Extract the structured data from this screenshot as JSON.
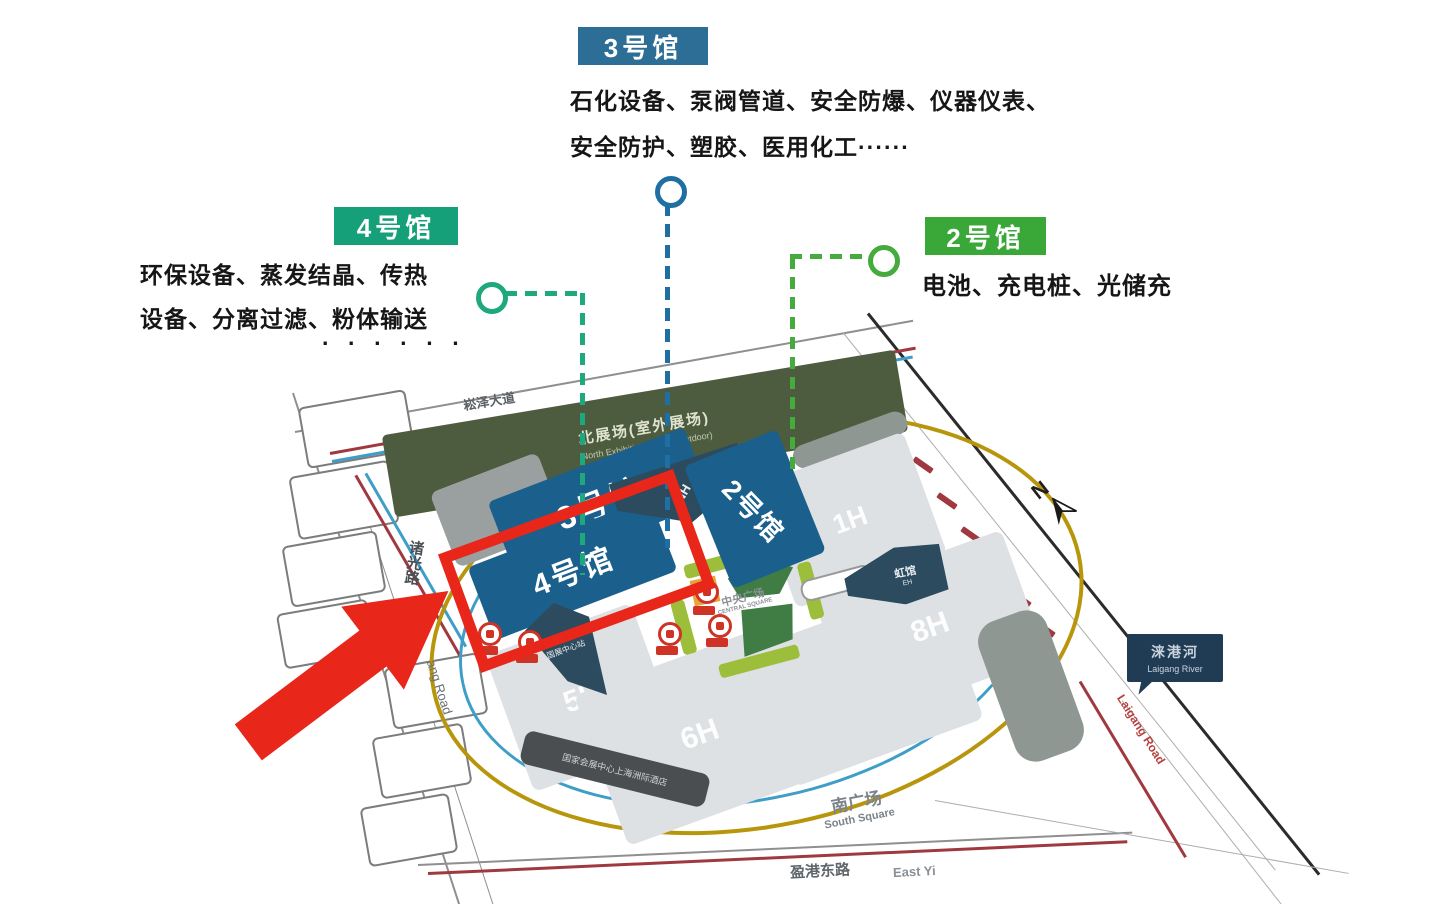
{
  "callouts": {
    "hall3": {
      "badge": "3号馆",
      "line1": "石化设备、泵阀管道、安全防爆、仪器仪表、",
      "line2": "安全防护、塑胶、医用化工······"
    },
    "hall4": {
      "badge": "4号馆",
      "line1": "环保设备、蒸发结晶、传热",
      "line2": "设备、分离过滤、粉体输送",
      "line3": "·  ·  ·  ·  ·  ·"
    },
    "hall2": {
      "badge": "2号馆",
      "line1": "电池、充电桩、光储充"
    }
  },
  "map": {
    "halls": {
      "h3": "3号馆",
      "h4": "4号馆",
      "h2": "2号馆",
      "h1": "1H",
      "h5": "5H",
      "h6": "6H",
      "h7": "7H",
      "h8": "8H",
      "nh": "NH",
      "eh_cn": "虹馆",
      "eh_en": "EH"
    },
    "areas": {
      "outdoor_cn": "北展场(室外展场)",
      "outdoor_en": "North Exhibition Space (Outdoor)",
      "central_cn": "中央广场",
      "central_en": "CENTRAL SQUARE",
      "south_cn": "南广场",
      "south_en": "South Square",
      "hotel": "国家会展中心上海洲际酒店",
      "station": "国展中心站"
    },
    "roads": {
      "songze": "崧泽大道",
      "zhuguang": "诸光路",
      "zhuguang_en": "ang Road",
      "yinggang": "盈港东路",
      "yinggang_en": "East Yi",
      "laigang_road": "Laigang Road"
    },
    "river": {
      "cn": "涞港河",
      "en": "Laigang River"
    },
    "compass_n": "N"
  },
  "colors": {
    "hall3_badge": "#2d6e96",
    "hall4_badge": "#16a079",
    "hall2_badge": "#3aa838",
    "hall_fill": "#1b608c",
    "hall_light": "#dde1e4",
    "dark_teal": "#2c4b5e",
    "outdoor_green": "#4d5c3f",
    "highlight_red": "#e8261a",
    "route_yellow": "#b8960c",
    "route_blue": "#3f9ec7",
    "route_red": "#a0393f"
  }
}
